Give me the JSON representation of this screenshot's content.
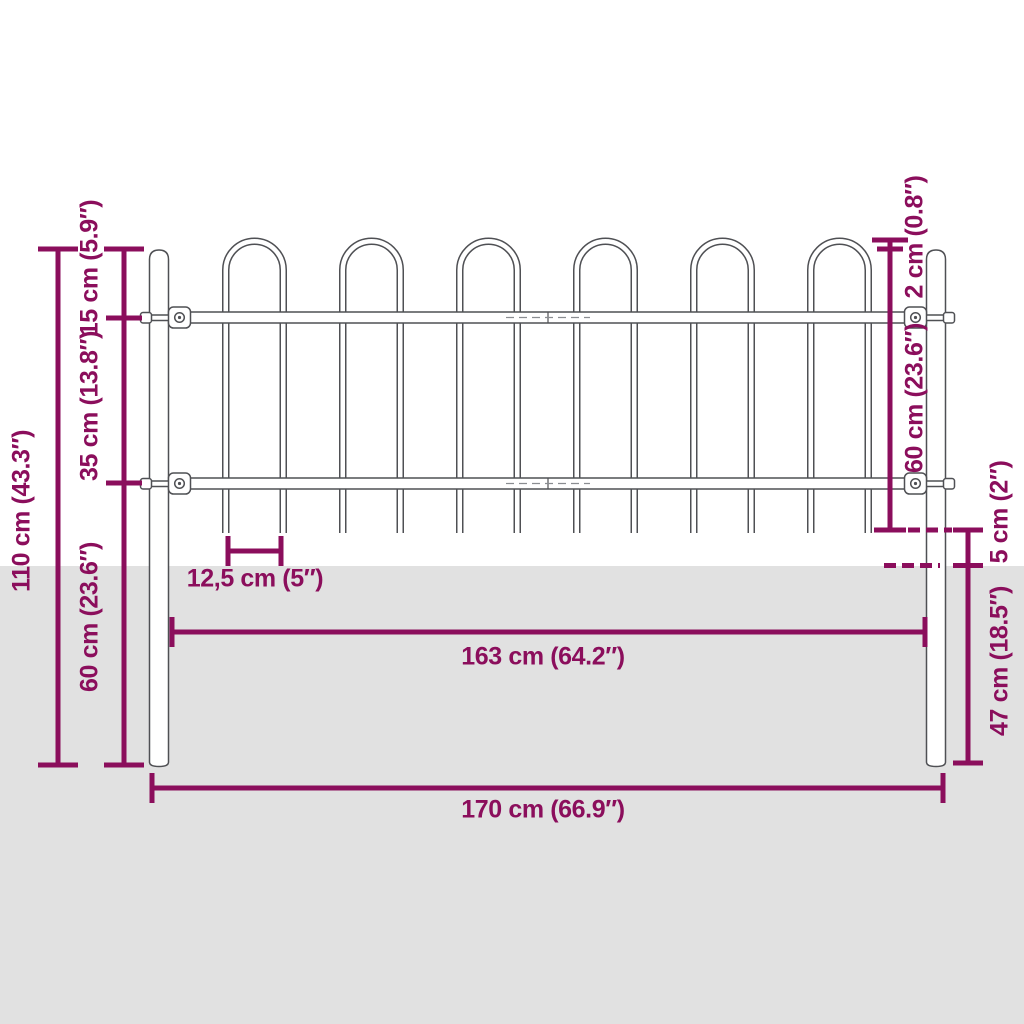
{
  "diagram": {
    "type": "product-dimension-diagram",
    "subject": "garden fence with hoop top, two ground posts",
    "colors": {
      "dimension_accent": "#8B0E5C",
      "ground": "#E1E1E1",
      "fence_outline": "#4F5054",
      "background": "#FFFFFF"
    },
    "dimensions": {
      "total_height": "110 cm (43.3″)",
      "hoop_section_height": "15 cm (5.9″)",
      "rail_spacing": "35 cm (13.8″)",
      "lower_post_left": "60 cm (23.6″)",
      "hoop_above_post": "2 cm (0.8″)",
      "fence_panel_height": "60 cm (23.6″)",
      "bar_above_ground": "5 cm (2″)",
      "post_underground": "47 cm (18.5″)",
      "bar_spacing": "12,5 cm (5″)",
      "panel_width": "163 cm (64.2″)",
      "total_width": "170 cm (66.9″)"
    }
  }
}
